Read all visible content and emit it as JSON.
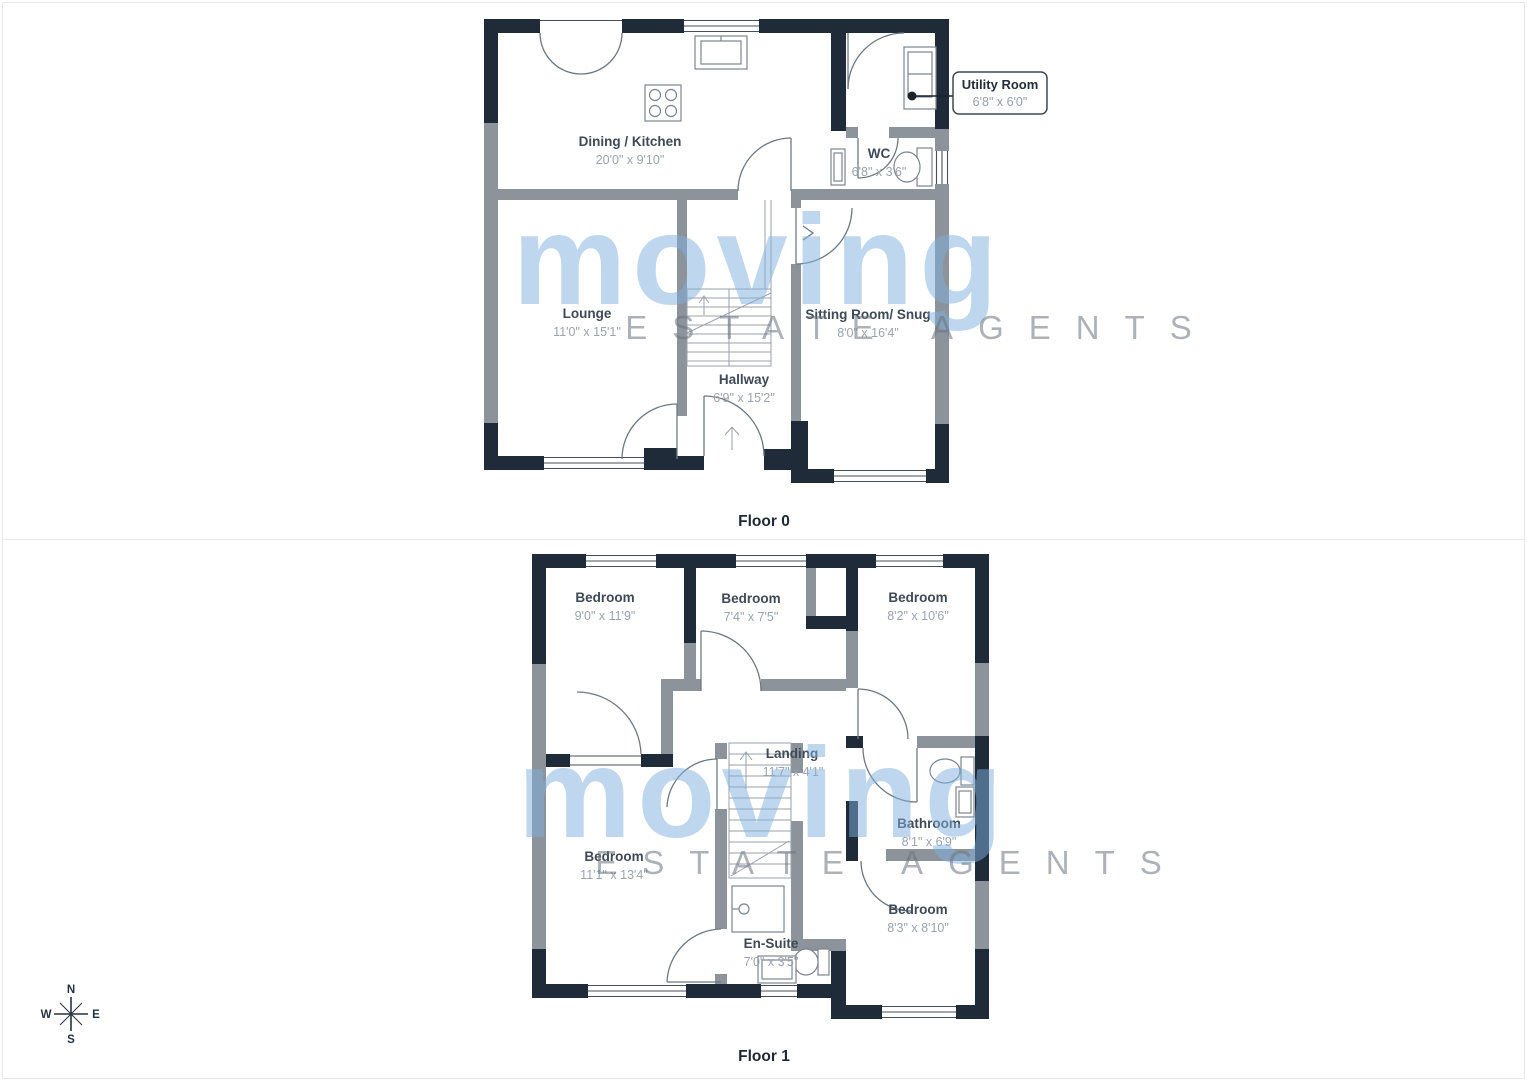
{
  "watermark": {
    "brand": "moving",
    "tagline": "ESTATE AGENTS"
  },
  "compass": {
    "n": "N",
    "s": "S",
    "e": "E",
    "w": "W"
  },
  "floor0": {
    "label": "Floor 0",
    "rooms": [
      {
        "name": "Dining / Kitchen",
        "dims": "20'0\" x 9'10\""
      },
      {
        "name": "WC",
        "dims": "6'8\" x 3'6\""
      },
      {
        "name": "Lounge",
        "dims": "11'0\" x 15'1\""
      },
      {
        "name": "Sitting Room/ Snug",
        "dims": "8'0\" x 16'4\""
      },
      {
        "name": "Hallway",
        "dims": "6'9\" x 15'2\""
      }
    ],
    "callout": {
      "name": "Utility Room",
      "dims": "6'8\" x 6'0\""
    }
  },
  "floor1": {
    "label": "Floor 1",
    "rooms": [
      {
        "name": "Bedroom",
        "dims": "9'0\" x 11'9\""
      },
      {
        "name": "Bedroom",
        "dims": "7'4\" x 7'5\""
      },
      {
        "name": "Bedroom",
        "dims": "8'2\" x 10'6\""
      },
      {
        "name": "Landing",
        "dims": "11'7\" x 4'1\""
      },
      {
        "name": "Bathroom",
        "dims": "8'1\" x 6'9\""
      },
      {
        "name": "Bedroom",
        "dims": "11'1\" x 13'4\""
      },
      {
        "name": "En-Suite",
        "dims": "7'0\" x 3'5\""
      },
      {
        "name": "Bedroom",
        "dims": "8'3\" x 8'10\""
      }
    ]
  },
  "colors": {
    "wall_dark": "#202b39",
    "wall_gray": "#8d939b",
    "watermark_blue": "#7fb0de",
    "label_dark": "#3e4a57",
    "dim_gray": "#9aa3ad"
  }
}
